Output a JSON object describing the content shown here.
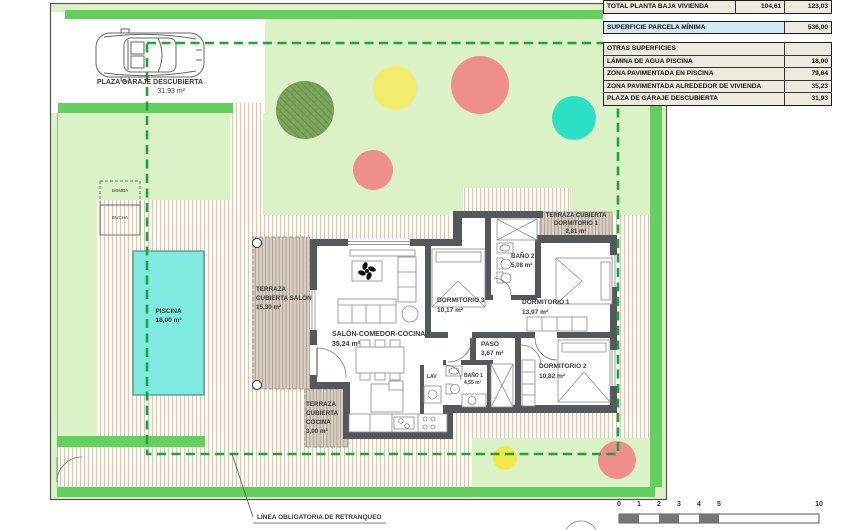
{
  "plan": {
    "garage": {
      "label": "PLAZA GARAJE DESCUBIERTA",
      "area": "31,93 m²"
    },
    "bomba": "BOMBA",
    "ducha": "DUCHA",
    "piscina": {
      "label": "PISCINA",
      "area": "18,00 m²"
    },
    "terraza_salon": {
      "l1": "TERRAZA",
      "l2": "CUBIERTA SALÓN",
      "area": "15,30 m²"
    },
    "salon": {
      "label": "SALÓN-COMEDOR-COCINA",
      "area": "35,24 m²"
    },
    "dorm3": {
      "label": "DORMITORIO 3",
      "area": "10,17 m²"
    },
    "bano2": {
      "label": "BAÑO 2",
      "area": "5,08 m²"
    },
    "dorm1": {
      "label": "DORMITORIO 1",
      "area": "13,97 m²"
    },
    "terraza_dorm1": {
      "l1": "TERRAZA CUBIERTA",
      "l2": "DORMITORIO 1",
      "area": "2,81 m²"
    },
    "paso": {
      "label": "PASO",
      "area": "3,67 m²"
    },
    "bano1": {
      "label": "BAÑO 1",
      "area": "4,55 m²"
    },
    "dorm2": {
      "label": "DORMITORIO 2",
      "area": "10,82 m²"
    },
    "terraza_cocina": {
      "l1": "TERRAZA",
      "l2": "CUBIERTA",
      "l3": "COCINA",
      "area": "3,00 m²"
    },
    "lav": "LAV",
    "setback_label": "LÍNEA OBLIGATORIA DE RETRANQUEO"
  },
  "tables": {
    "total": {
      "label": "TOTAL PLANTA BAJA VIVIENDA",
      "v1": "104,61",
      "v2": "123,03"
    },
    "parcela": {
      "label": "SUPERFICIE PARCELA MÍNIMA",
      "value": "536,00"
    },
    "otras": {
      "header": "OTRAS SUPERFICIES",
      "rows": [
        {
          "label": "LÁMINA DE AGUA PISCINA",
          "value": "18,00"
        },
        {
          "label": "ZONA PAVIMENTADA EN PISCINA",
          "value": "79,64"
        },
        {
          "label": "ZONA PAVIMENTADA ALREDEDOR DE VIVIENDA",
          "value": "35,23"
        },
        {
          "label": "PLAZA DE GARAJE DESCUBIERTA",
          "value": "31,93"
        }
      ]
    }
  },
  "scalebar": {
    "ticks": [
      "0",
      "1",
      "2",
      "3",
      "4",
      "5",
      "10"
    ]
  },
  "colors": {
    "lawn": "#dbf2c6",
    "hedge_green": "#62cf5f",
    "setback_green": "#17a637",
    "pool": "#7feadf",
    "wall": "#54585c",
    "paving_line": "#cdbca8",
    "terrace": "#d8cec2",
    "circle_dark_green": "#7ea55d",
    "circle_yellow": "#f3ed6e",
    "circle_salmon": "#ee8f8c",
    "circle_teal": "#2ce0c6",
    "table_row": "#edebdd",
    "table_blue": "#d2eaf6"
  }
}
